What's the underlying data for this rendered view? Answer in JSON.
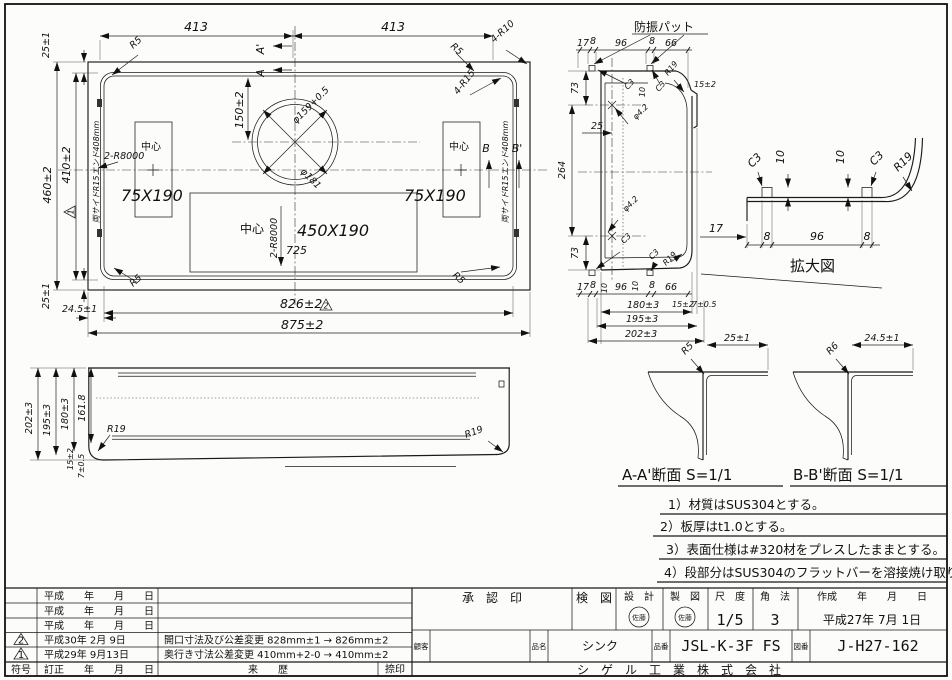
{
  "plan_view": {
    "dim_413_left": "413",
    "dim_413_right": "413",
    "dim_460": "460±2",
    "dim_410": "410±2",
    "dim_25_top": "25±1",
    "dim_25_bottom": "25±1",
    "dim_150": "150±2",
    "dim_826": "826±2",
    "dim_875": "875±2",
    "dim_24_5": "24.5±1",
    "dim_725": "725",
    "dia_hole": "φ159+0.5",
    "dia_rim": "φ181",
    "r5": "R5",
    "r10": "4-R10",
    "r15": "4-R15",
    "r8000": "2-R8000",
    "pocket_small": "75X190",
    "pocket_large": "450X190",
    "center_mark": "中心",
    "edge_note": "両サイドR15エンド408mm",
    "sec_a": "A",
    "sec_a2": "A'",
    "sec_b": "B",
    "sec_b2": "B'",
    "rev1": "1",
    "rev2": "2"
  },
  "side_view": {
    "dim_202": "202±3",
    "dim_195": "195±3",
    "dim_180": "180±3",
    "dim_161": "161.8",
    "dim_15": "15±2",
    "dim_7": "7±0.5",
    "r19": "R19"
  },
  "section_view": {
    "pad_label": "防振パット",
    "chain": [
      "17",
      "8",
      "96",
      "8",
      "66"
    ],
    "dim_73": "73",
    "dim_264": "264",
    "dim_25": "25",
    "dia_hole": "φ4.2",
    "c3": "C3",
    "dim_10": "10",
    "r19": "R19",
    "dim_15": "15±2",
    "dim_180": "180±3",
    "dim_7": "7±0.5",
    "dim_195": "195±3",
    "dim_202": "202±3",
    "dim_17": "17"
  },
  "enlarged_view": {
    "title": "拡大図",
    "c3": "C3",
    "dim_10": "10",
    "r19": "R19",
    "chain": [
      "17",
      "8",
      "96",
      "8"
    ]
  },
  "detail_a": {
    "title": "A-A'断面 S=1/1",
    "radius": "R5",
    "dim": "25±1"
  },
  "detail_b": {
    "title": "B-B'断面 S=1/1",
    "radius": "R6",
    "dim": "24.5±1"
  },
  "notes": [
    "1）材質はSUS304とする。",
    "2）板厚はt1.0とする。",
    "3）表面仕様は#320材をプレスしたままとする。",
    "4）段部分はSUS304のフラットバーを溶接焼け取り仕上げとする。"
  ],
  "revision_table": {
    "rows": [
      {
        "sym": "",
        "date": "平成　　年　　月　　日",
        "desc": ""
      },
      {
        "sym": "",
        "date": "平成　　年　　月　　日",
        "desc": ""
      },
      {
        "sym": "",
        "date": "平成　　年　　月　　日",
        "desc": ""
      },
      {
        "sym": "2",
        "date": "平成30年 2月 9日",
        "desc": "開口寸法及び公差変更 828mm±1 → 826mm±2"
      },
      {
        "sym": "1",
        "date": "平成29年 9月13日",
        "desc": "奥行き寸法公差変更 410mm+2-0 → 410mm±2"
      }
    ],
    "footer_sym": "符号",
    "footer_date": "訂正　　年　　月　　日",
    "footer_history": "来　　歴",
    "footer_seal": "捺印"
  },
  "title_block": {
    "approval": "承　認　印",
    "check": "検　図",
    "design": "設　計",
    "draft": "製　図",
    "design_seal": "佐藤",
    "draft_seal": "佐藤",
    "scale_label": "尺　度",
    "scale": "1/5",
    "projection_label": "角　法",
    "projection": "3",
    "created_label": "作成　　年　　月　　日",
    "created": "平成27年 7月 1日",
    "customer_label": "顧客",
    "product_label": "品名",
    "product": "シンク",
    "part_label": "品番",
    "part": "JSL-K-3F FS",
    "drawing_label": "図番",
    "drawing_no": "J-H27-162",
    "company": "シ　ゲ　ル　工　業　株　式　会　社"
  }
}
